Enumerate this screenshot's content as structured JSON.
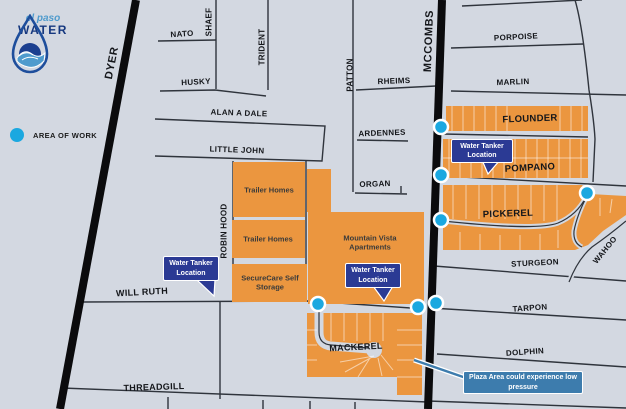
{
  "title": "El Paso Water area of work map",
  "logo": {
    "line1": "el paso",
    "line2": "WATER"
  },
  "legend": {
    "label": "AREA OF WORK"
  },
  "streets": {
    "dyer": "DYER",
    "mccombs": "MCCOMBS",
    "nato": "NATO",
    "shaef": "SHAEF",
    "trident": "TRIDENT",
    "husky": "HUSKY",
    "alan_a_dale": "ALAN A DALE",
    "little_john": "LITTLE JOHN",
    "robin_hood": "ROBIN HOOD",
    "patton": "PATTON",
    "rheims": "RHEIMS",
    "ardennes": "ARDENNES",
    "organ": "ORGAN",
    "porpoise": "PORPOISE",
    "marlin": "MARLIN",
    "flounder": "FLOUNDER",
    "pompano": "POMPANO",
    "pickerel": "PICKEREL",
    "wahoo": "WAHOO",
    "sturgeon": "STURGEON",
    "tarpon": "TARPON",
    "dolphin": "DOLPHIN",
    "mackerel": "MACKEREL",
    "will_ruth": "WILL RUTH",
    "threadgill": "THREADGILL"
  },
  "areas": {
    "trailer_homes": "Trailer Homes",
    "securecare": "SecureCare Self Storage",
    "mountain_vista": "Mountain Vista Apartments"
  },
  "callouts": {
    "water_tanker": "Water Tanker Location",
    "plaza": "Plaza Area could experience low pressure"
  },
  "colors": {
    "map_background": "#D3D8E1",
    "highlight_orange": "#EB963F",
    "road_black": "#0B0B0D",
    "street_gray": "#2F343C",
    "marker_cyan": "#1BA8E0",
    "callout_navy": "#2B3A94",
    "plaza_blue": "#3D7CAD",
    "logo_light_blue": "#4F9BCD",
    "logo_navy": "#16387F"
  }
}
